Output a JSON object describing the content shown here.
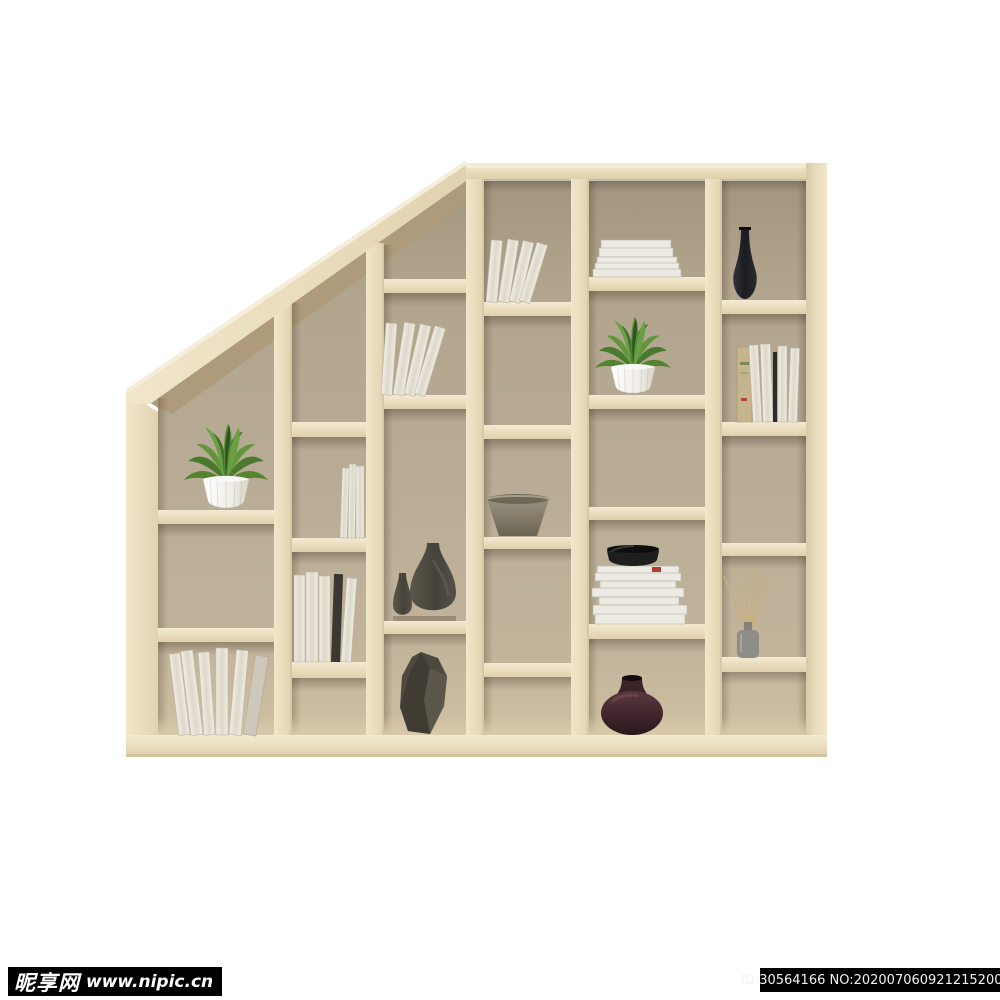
{
  "image": {
    "description": "Product photo of a light-wood staircase-style cube bookshelf on a white background, decorated with plants, white books, magazines, bowls and dark ceramic vases",
    "shelf": {
      "material": "light beech wood",
      "shape": "stepped unit with sloped top-left edge",
      "columns": 6,
      "background": "white"
    }
  },
  "shelf_items": [
    {
      "id": 1,
      "label": "potted-plant",
      "location": "column 1, middle shelf"
    },
    {
      "id": 2,
      "label": "leaning-white-books",
      "location": "column 1, bottom cell"
    },
    {
      "id": 3,
      "label": "thin-white-books",
      "location": "column 2, upper-middle cell"
    },
    {
      "id": 4,
      "label": "white-books-with-dark-book",
      "location": "column 2, lower-middle cell"
    },
    {
      "id": 5,
      "label": "leaning-white-books",
      "location": "column 3, upper cell"
    },
    {
      "id": 6,
      "label": "two-dark-ceramic-vases",
      "location": "column 3, middle cell"
    },
    {
      "id": 7,
      "label": "faceted-dark-vase",
      "location": "column 3, bottom cell"
    },
    {
      "id": 8,
      "label": "leaning-white-books",
      "location": "column 4, top cell"
    },
    {
      "id": 9,
      "label": "taupe-bowl",
      "location": "column 4, middle shelf"
    },
    {
      "id": 10,
      "label": "stack-of-white-books",
      "location": "column 5, top cell"
    },
    {
      "id": 11,
      "label": "potted-plant",
      "location": "column 5, upper-middle cell"
    },
    {
      "id": 12,
      "label": "magazine-stack-with-black-bowl",
      "location": "column 5, lower-middle cell"
    },
    {
      "id": 13,
      "label": "dark-purple-round-vase",
      "location": "column 5, bottom cell"
    },
    {
      "id": 14,
      "label": "slim-black-vase",
      "location": "column 6, top cell"
    },
    {
      "id": 15,
      "label": "books-with-tan-spine",
      "location": "column 6, upper-middle cell"
    },
    {
      "id": 16,
      "label": "reed-diffuser",
      "location": "column 6, lower-middle cell"
    }
  ],
  "palette": {
    "wood": "#ecdfc2",
    "wood_light": "#f4ecd6",
    "wood_shadow": "#d9caa8",
    "interior": "#b3a68f",
    "interior_dark": "#a0937d",
    "page_background": "#ffffff",
    "watermark_bar": "#000000",
    "watermark_text": "#ffffff"
  },
  "watermarks": {
    "left": {
      "site_name": "昵享网",
      "site_url": "www.nipic.cn"
    },
    "right": {
      "text": "ID:30564166 NO:20200706092121520081"
    }
  }
}
